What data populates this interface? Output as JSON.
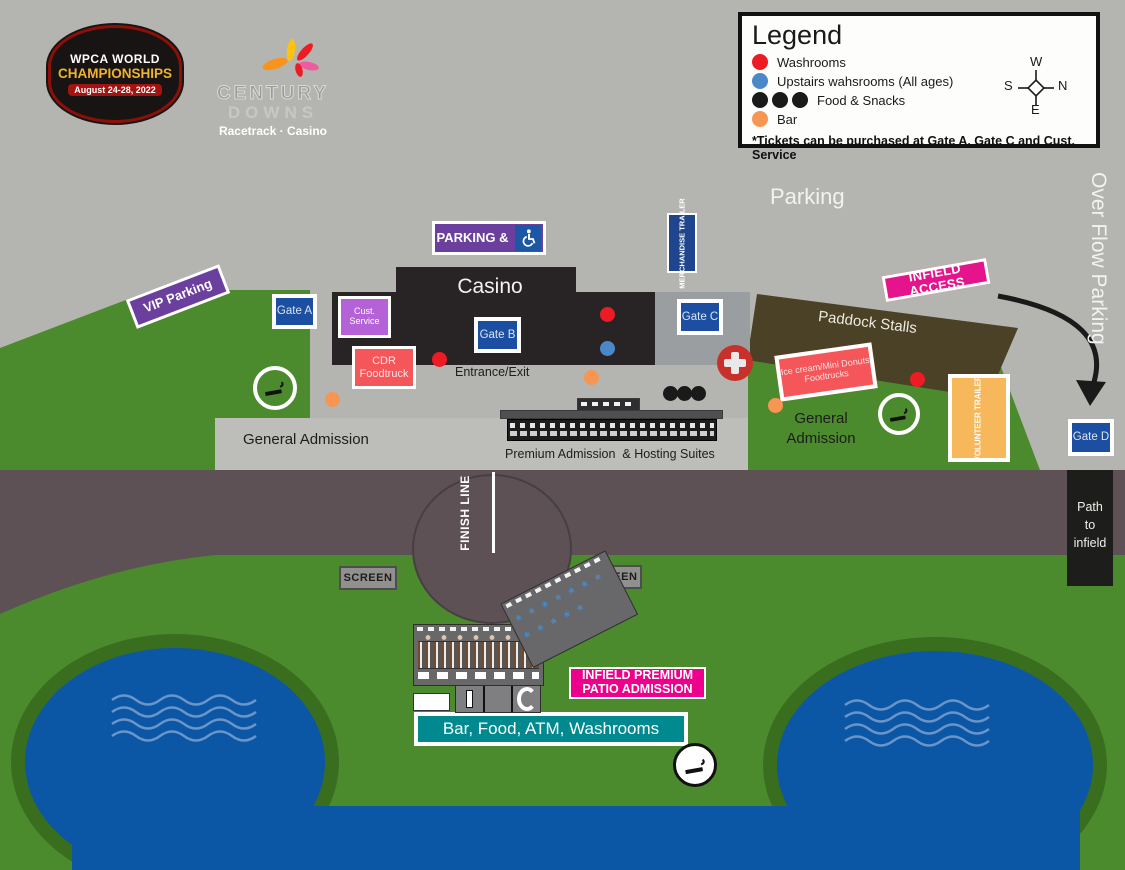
{
  "colors": {
    "background": "#b4b5b1",
    "track": "#5d5156",
    "grass": "#4c8a2e",
    "grass_dark": "#3a6e1f",
    "pond": "#0c56a6",
    "wave": "#6a95c8",
    "casino_black": "#282325",
    "paddock_brown": "#4a4126",
    "gate_blue": "#1c4fa1",
    "purple": "#6b3f9d",
    "magenta": "#e6148c",
    "pink": "#ec008c",
    "teal": "#00898e",
    "salmon": "#f4565a",
    "violet": "#b561d8",
    "orange_trailer": "#f6b85b",
    "washroom_red": "#ed1c24",
    "upstairs_blue": "#4a88c7",
    "food_black": "#1a1a1a",
    "bar_orange": "#f79552"
  },
  "header": {
    "wpca": {
      "line1": "WPCA WORLD",
      "line2": "CHAMPIONSHIPS",
      "line3": "August 24-28, 2022"
    },
    "century": {
      "word1": "CENTURY",
      "word2": "DOWNS",
      "tagline": "Racetrack · Casino"
    }
  },
  "legend": {
    "title": "Legend",
    "items": [
      {
        "label": "Washrooms"
      },
      {
        "label": "Upstairs wahsrooms (All ages)"
      },
      {
        "label": "Food & Snacks"
      },
      {
        "label": "Bar"
      }
    ],
    "compass": {
      "w": "W",
      "s": "S",
      "n": "N",
      "e": "E"
    },
    "footnote": "*Tickets can be purchased at Gate A, Gate C and Cust. Service"
  },
  "map": {
    "parking": "Parking",
    "overflow_parking": "Over Flow Parking",
    "vip_parking": "VIP Parking",
    "accessible_parking": "PARKING &",
    "merchandise_trailer": "MERCHANDISE TRAILER",
    "casino": "Casino",
    "gate_a": "Gate A",
    "gate_b": "Gate B",
    "gate_c": "Gate C",
    "gate_d": "Gate D",
    "cust_service_line1": "Cust.",
    "cust_service_line2": "Service",
    "cdr_line1": "CDR",
    "cdr_line2": "Foodtruck",
    "entrance_exit": "Entrance/Exit",
    "infield_access": "INFIELD ACCESS",
    "paddock_stalls": "Paddock Stalls",
    "icecream_line1": "Ice cream/Mini Donuts",
    "icecream_line2": "Foodtrucks",
    "general_admission_left": "General Admission",
    "general_admission_right_line1": "General",
    "general_admission_right_line2": "Admission",
    "premium_admission": "Premium Admission  & Hosting Suites",
    "volunteer_trailer": "VOLUNTEER TRAILER",
    "path_line1": "Path",
    "path_line2": "to",
    "path_line3": "infield",
    "finish_line": "FINISH LINE",
    "screen_left": "SCREEN",
    "screen_right": "SCREEN",
    "infield_premium_line1": "INFIELD PREMIUM",
    "infield_premium_line2": "PATIO ADMISSION",
    "bar_food": "Bar, Food, ATM, Washrooms"
  }
}
